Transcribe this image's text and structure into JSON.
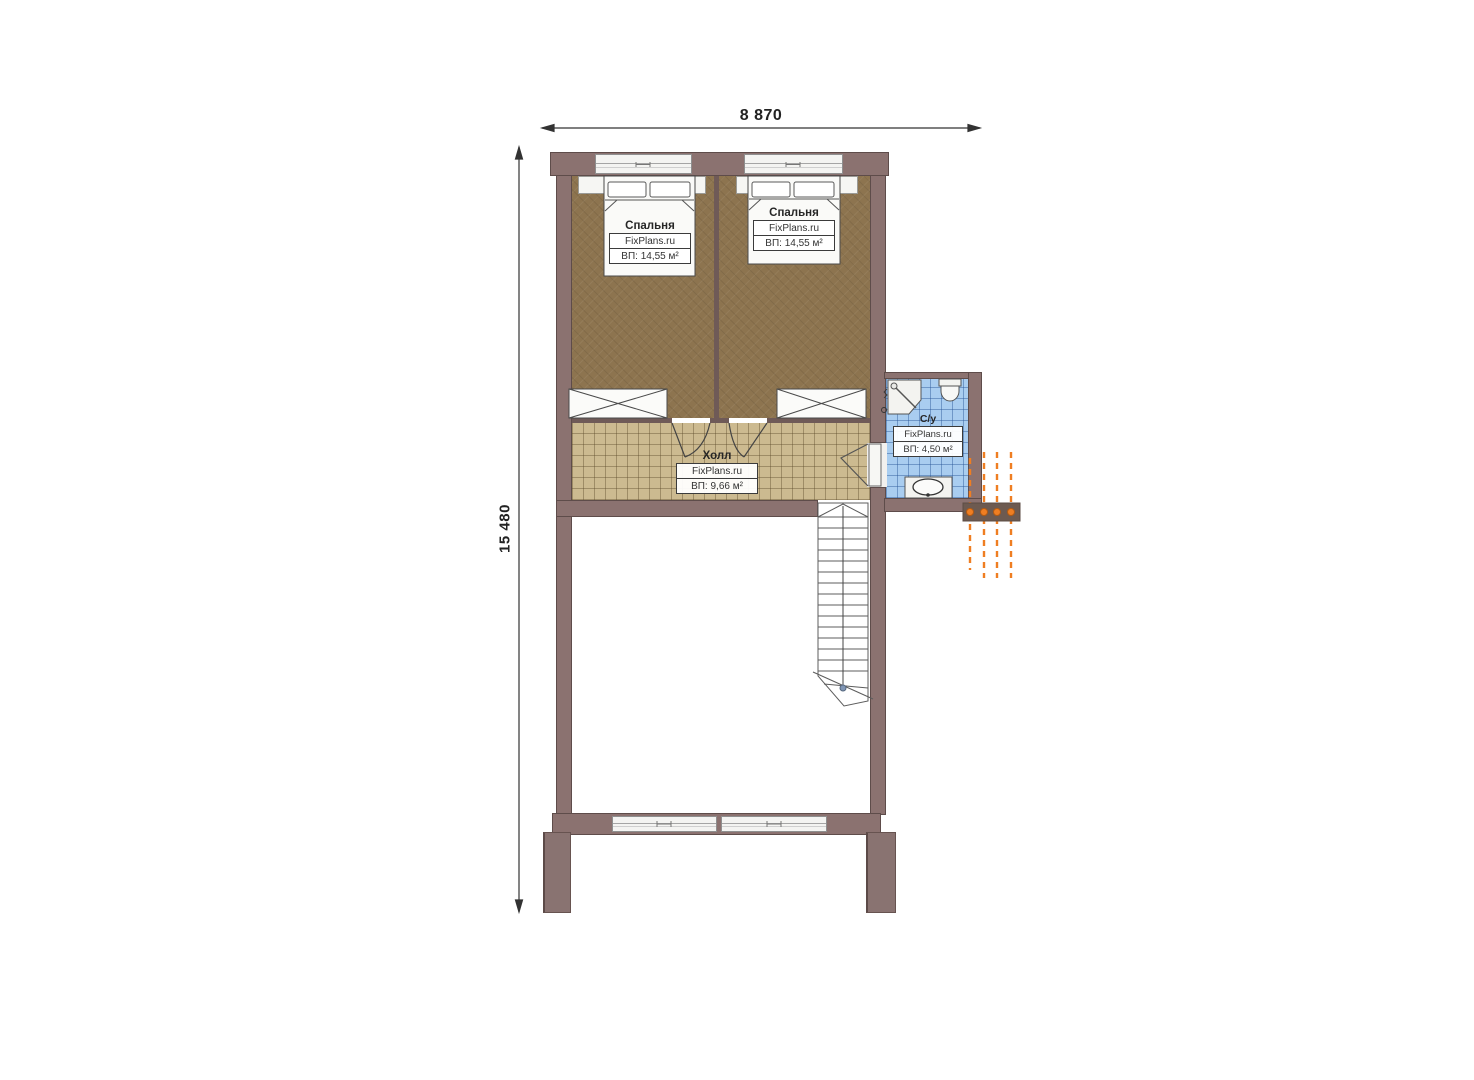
{
  "dimensions": {
    "width": "8 870",
    "height": "15 480"
  },
  "rooms": {
    "bedroom_left": {
      "name": "Спальня",
      "watermark": "FixPlans.ru",
      "area": "ВП: 14,55 м²"
    },
    "bedroom_right": {
      "name": "Спальня",
      "watermark": "FixPlans.ru",
      "area": "ВП: 14,55 м²"
    },
    "hall": {
      "name": "Холл",
      "watermark": "FixPlans.ru",
      "area": "ВП: 9,66 м²"
    },
    "bathroom": {
      "name": "С/у",
      "watermark": "FixPlans.ru",
      "area": "ВП: 4,50 м²"
    }
  },
  "colors": {
    "wall": "#8b7270",
    "wall_outline": "#5e4c4a",
    "bedroom_floor": "#8d744f",
    "hall_floor": "#ccba90",
    "bathroom_floor": "#a9cdf0",
    "accent_orange": "#ef7e22",
    "pergola_band": "#6d5a50",
    "dimension_text": "#222222"
  }
}
